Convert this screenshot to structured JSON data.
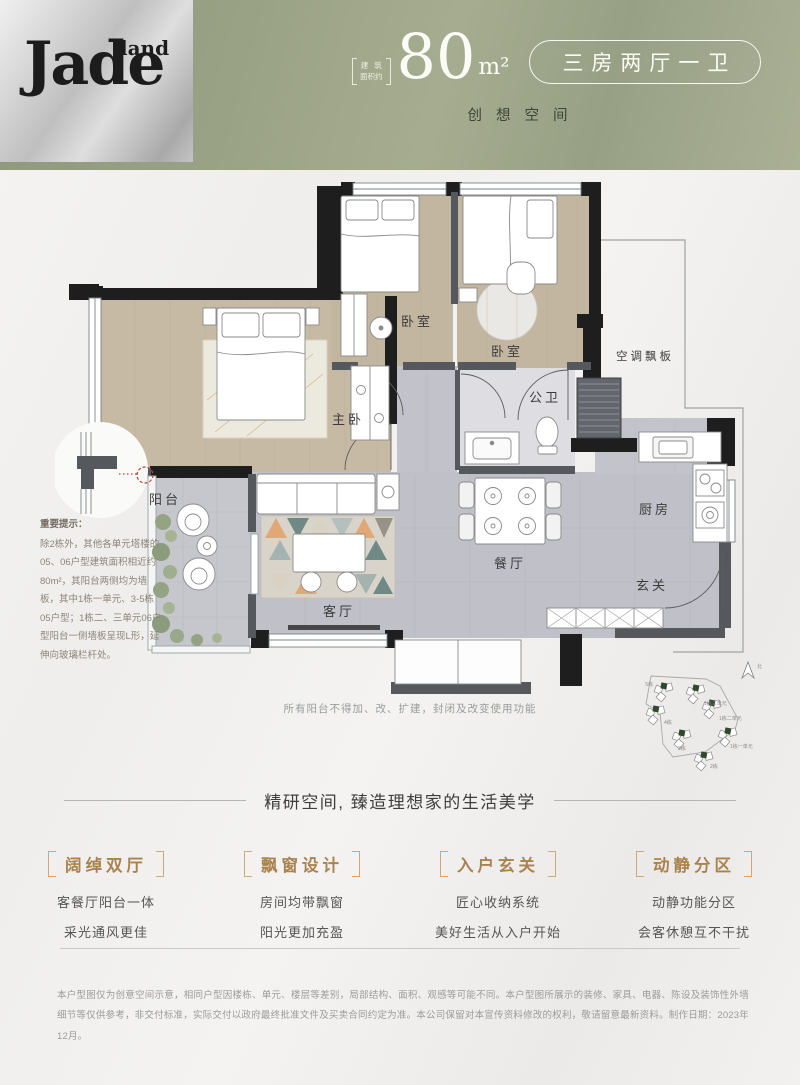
{
  "header": {
    "logo_main": "Jade",
    "logo_sub": "land",
    "area_label_line1": "建筑",
    "area_label_line2": "面积约",
    "area_value": "80",
    "area_unit": "m²",
    "type_badge": "三房两厅一卫",
    "slogan": "创想空间"
  },
  "floorplan": {
    "rooms": {
      "balcony": "阳台",
      "master": "主卧",
      "bedroom_top": "卧室",
      "bedroom_right": "卧室",
      "bathroom": "公卫",
      "ac_panel": "空调飘板",
      "dining": "餐厅",
      "living": "客厅",
      "kitchen": "厨房",
      "foyer": "玄关"
    },
    "notice": {
      "title": "重要提示：",
      "body": "除2栋外，其他各单元塔楼的05、06户型建筑面积相近约80m²，其阳台两侧均为墙板，其中1栋一单元、3-5栋05户型；1栋二、三单元06户型阳台一侧墙板呈现L形，延伸向玻璃栏杆处。"
    },
    "caption": "所有阳台不得加、改、扩建，封闭及改变使用功能",
    "sitemap": {
      "north": "北",
      "labels": [
        "5栋",
        "1栋三单元",
        "4栋",
        "1栋二单元",
        "3栋",
        "1栋一单元",
        "2栋"
      ]
    }
  },
  "features": {
    "section_title": "精研空间, 臻造理想家的生活美学",
    "items": [
      {
        "title": "阔绰双厅",
        "line1": "客餐厅阳台一体",
        "line2": "采光通风更佳"
      },
      {
        "title": "飘窗设计",
        "line1": "房间均带飘窗",
        "line2": "阳光更加充盈"
      },
      {
        "title": "入户玄关",
        "line1": "匠心收纳系统",
        "line2": "美好生活从入户开始"
      },
      {
        "title": "动静分区",
        "line1": "动静功能分区",
        "line2": "会客休憩互不干扰"
      }
    ]
  },
  "footer": {
    "disclaimer": "本户型图仅为创意空间示意，相同户型因楼栋、单元、楼层等差别，局部结构、面积、观感等可能不同。本户型图所展示的装修、家具、电器、陈设及装饰性外墙细节等仅供参考，非交付标准，实际交付以政府最终批准文件及买卖合同约定为准。本公司保留对本宣传资料修改的权利，敬请留意最新资料。制作日期：2023年12月。"
  },
  "colors": {
    "header_green": "#9aa286",
    "logo_silver": "#c9c9c9",
    "gold_accent": "#a9834f",
    "wall_black": "#1e1e1e",
    "wood_floor": "#c4b8a3",
    "marble_gray": "#bfc0c8",
    "marker_red": "#c24034"
  }
}
